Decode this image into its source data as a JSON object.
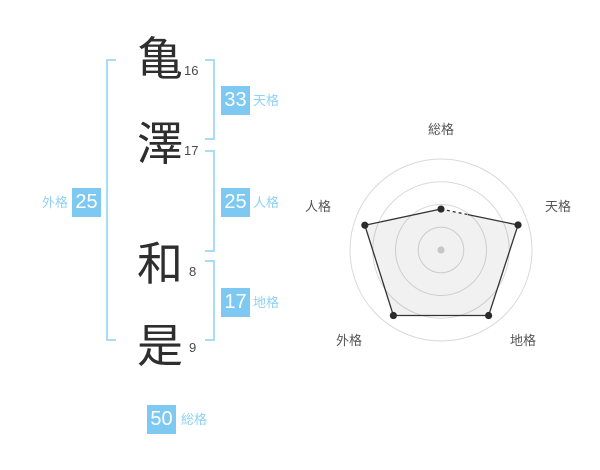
{
  "name": {
    "surname": [
      {
        "char": "亀",
        "strokes": "16"
      },
      {
        "char": "澤",
        "strokes": "17"
      }
    ],
    "given": [
      {
        "char": "和",
        "strokes": "8"
      },
      {
        "char": "是",
        "strokes": "9"
      }
    ]
  },
  "kaku": {
    "gaikaku": {
      "label": "外格",
      "value": "25"
    },
    "tenkaku": {
      "label": "天格",
      "value": "33"
    },
    "jinkaku": {
      "label": "人格",
      "value": "25"
    },
    "chikaku": {
      "label": "地格",
      "value": "17"
    },
    "soukaku": {
      "label": "総格",
      "value": "50"
    }
  },
  "colors": {
    "accent": "#7ec9f1",
    "label": "#8fd1f4",
    "bracket": "#a9dcf7",
    "ink": "#2e2e2e",
    "numgray": "#4a4a4a",
    "axisgray": "#555555",
    "grid": "#d9d9d9",
    "poly": "#333333",
    "dot": "#2b2b2b",
    "centerdot": "#c6c6c6"
  },
  "chart_data": {
    "type": "radar",
    "axes": [
      "総格",
      "天格",
      "地格",
      "外格",
      "人格"
    ],
    "values_pct": [
      45,
      89,
      89,
      89,
      88
    ],
    "max_pct": 100,
    "rings": 4,
    "grid_shape": "circular",
    "legend": "none",
    "notes": "polygon edge from 総格 toward 天格 starts with a short dashed portion; dark dots on vertices; gray dot at center"
  }
}
